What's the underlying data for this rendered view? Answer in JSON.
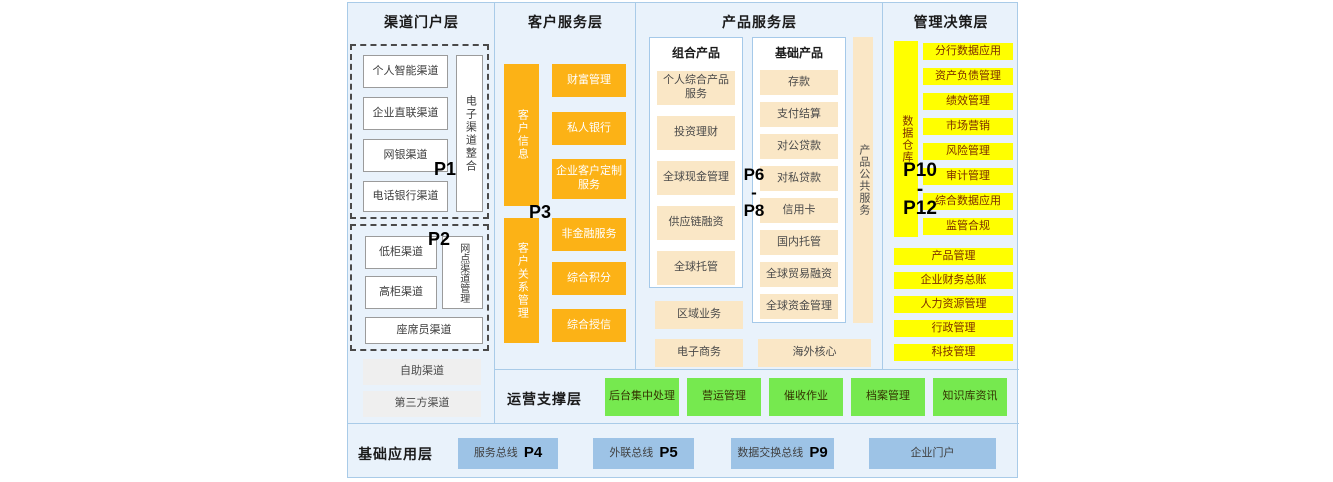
{
  "colors": {
    "background": "#e9f2fb",
    "border": "#a9cbe8",
    "orange": "#fcb216",
    "beige": "#fae7c6",
    "yellow": "#ffff00",
    "yellow_text": "#7c2d00",
    "green": "#76e94f",
    "blue_bus": "#9dc3e6",
    "gray": "#efefef"
  },
  "channel": {
    "title": "渠道门户层",
    "p1": "P1",
    "p2": "P2",
    "group1_items": [
      "个人智能渠道",
      "企业直联渠道",
      "网银渠道",
      "电话银行渠道"
    ],
    "group1_side": "电子渠道整合",
    "group2_items": [
      "低柜渠道",
      "高柜渠道"
    ],
    "group2_side": "网点渠道管理",
    "group2_bottom": "座席员渠道",
    "extra_items": [
      "自助渠道",
      "第三方渠道"
    ]
  },
  "customer": {
    "title": "客户服务层",
    "p3": "P3",
    "bar_top": "客户信息",
    "bar_bottom": "客户关系管理",
    "items_top": [
      "财富管理",
      "私人银行",
      "企业客户定制服务"
    ],
    "items_bottom": [
      "非金融服务",
      "综合积分",
      "综合授信"
    ]
  },
  "product": {
    "title": "产品服务层",
    "p_range": [
      "P6",
      "-",
      "P8"
    ],
    "combo_title": "组合产品",
    "combo_items": [
      "个人综合产品服务",
      "投资理财",
      "全球现金管理",
      "供应链融资",
      "全球托管"
    ],
    "base_title": "基础产品",
    "base_items": [
      "存款",
      "支付结算",
      "对公贷款",
      "对私贷款",
      "信用卡",
      "国内托管",
      "全球贸易融资",
      "全球资金管理"
    ],
    "side_bar": "产品公共服务",
    "left_extra": [
      "区域业务",
      "电子商务"
    ],
    "bottom_extra": "海外核心"
  },
  "management": {
    "title": "管理决策层",
    "p_range": [
      "P10",
      "-",
      "P12"
    ],
    "bar": "数据仓库",
    "items_right": [
      "分行数据应用",
      "资产负债管理",
      "绩效管理",
      "市场营销",
      "风险管理",
      "审计管理",
      "综合数据应用",
      "监管合规"
    ],
    "items_full": [
      "产品管理",
      "企业财务总账",
      "人力资源管理",
      "行政管理",
      "科技管理"
    ]
  },
  "operations": {
    "title": "运营支撑层",
    "items": [
      "后台集中处理",
      "营运管理",
      "催收作业",
      "档案管理",
      "知识库资讯"
    ]
  },
  "foundation": {
    "title": "基础应用层",
    "items": [
      {
        "label": "服务总线",
        "p": "P4"
      },
      {
        "label": "外联总线",
        "p": "P5"
      },
      {
        "label": "数据交换总线",
        "p": "P9"
      },
      {
        "label": "企业门户",
        "p": ""
      }
    ]
  }
}
